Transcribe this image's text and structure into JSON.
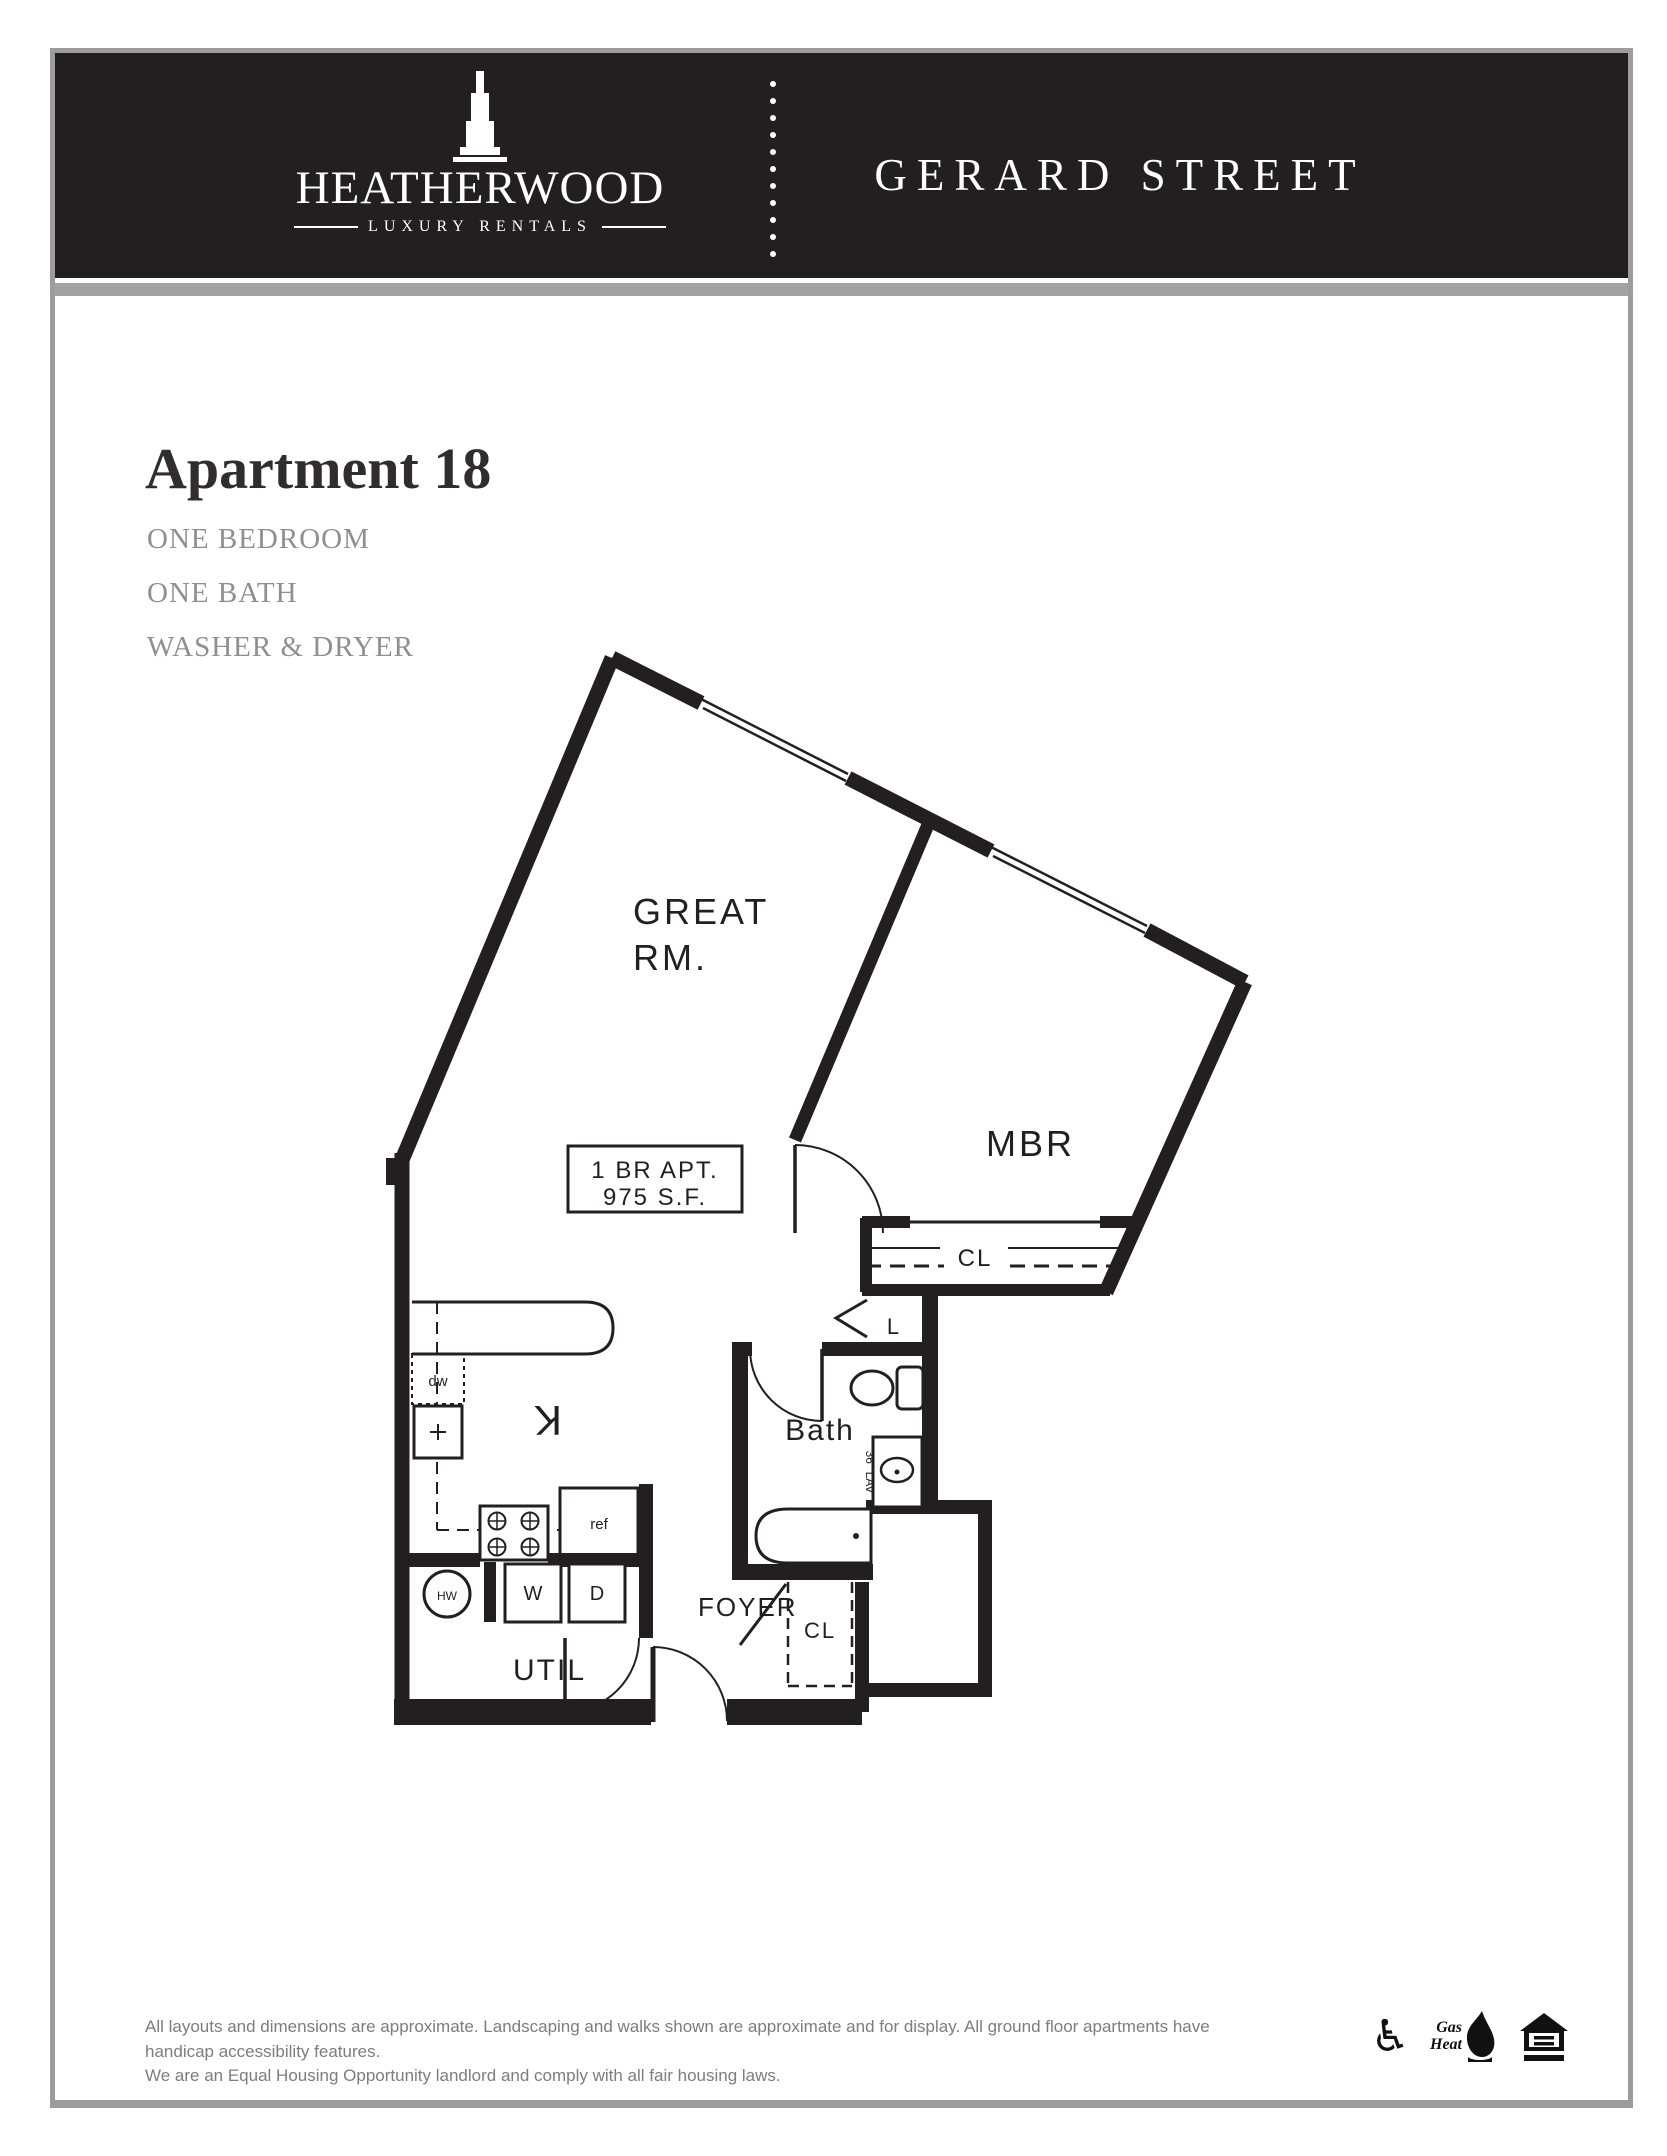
{
  "brand": {
    "name": "HEATHERWOOD",
    "tagline": "LUXURY RENTALS"
  },
  "property": {
    "name": "GERARD STREET"
  },
  "apartment": {
    "title": "Apartment 18",
    "features": {
      "f1": "ONE BEDROOM",
      "f2": "ONE BATH",
      "f3": "WASHER & DRYER"
    }
  },
  "plan": {
    "area_box": {
      "line1": "1 BR APT.",
      "line2": "975 S.F."
    },
    "rooms": {
      "great1": "GREAT",
      "great2": "RM.",
      "mbr": "MBR",
      "kitchen": "K",
      "bath": "Bath",
      "foyer": "FOYER",
      "util": "UTIL",
      "cl_master": "CL",
      "cl_foyer": "CL",
      "linen": "L"
    },
    "fixtures": {
      "dw": "dw",
      "ref": "ref",
      "washer": "W",
      "dryer": "D",
      "hot_water": "HW",
      "lav": "36\" LAV"
    }
  },
  "footer": {
    "disclaimer1": "All layouts and dimensions are approximate. Landscaping and walks shown are approximate and for display. All ground floor apartments have handicap accessibility features.",
    "disclaimer2": "We are an Equal Housing Opportunity landlord and comply with all fair housing laws.",
    "gas1": "Gas",
    "gas2": "Heat"
  }
}
